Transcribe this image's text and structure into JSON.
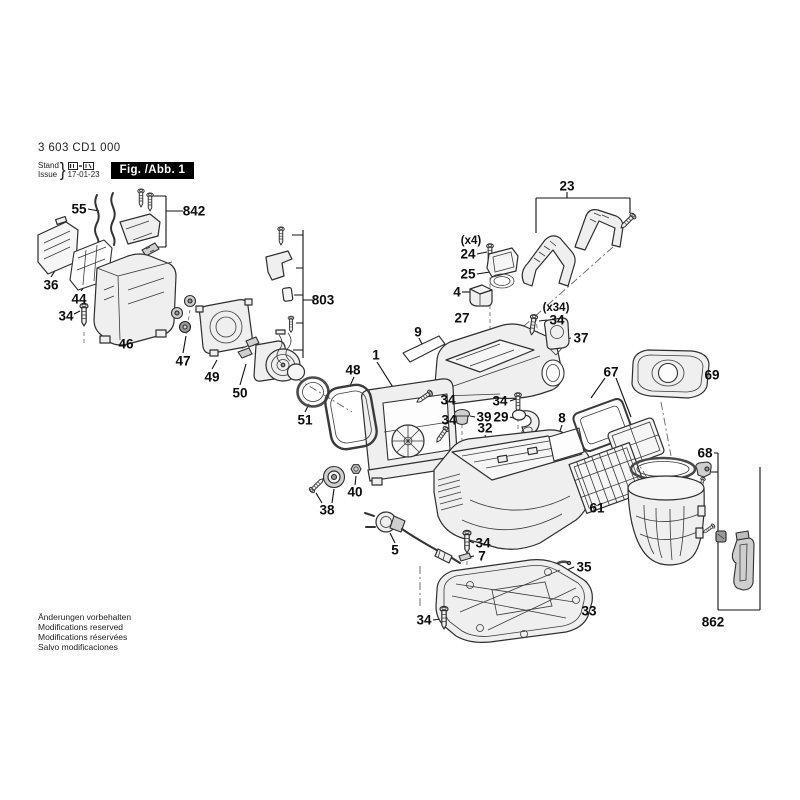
{
  "header": {
    "part_number": "3 603 CD1 000",
    "stand_label": "Stand",
    "issue_label": "Issue",
    "brace": "}",
    "date": "17-01-23",
    "figure_label": "Fig. /Abb. 1"
  },
  "footer": {
    "lines": [
      "Änderungen vorbehalten",
      "Modifications reserved",
      "Modifications réservées",
      "Salvo modificaciones"
    ]
  },
  "diagram": {
    "ink_color": "#111111",
    "badge_bg": "#000000",
    "badge_fg": "#ffffff",
    "labels": [
      {
        "text": "55",
        "x": 79,
        "y": 209
      },
      {
        "text": "842",
        "x": 194,
        "y": 211
      },
      {
        "text": "36",
        "x": 51,
        "y": 285
      },
      {
        "text": "44",
        "x": 79,
        "y": 299
      },
      {
        "text": "34",
        "x": 66,
        "y": 316
      },
      {
        "text": "46",
        "x": 126,
        "y": 344
      },
      {
        "text": "47",
        "x": 183,
        "y": 361
      },
      {
        "text": "49",
        "x": 212,
        "y": 377
      },
      {
        "text": "50",
        "x": 240,
        "y": 393
      },
      {
        "text": "51",
        "x": 305,
        "y": 420
      },
      {
        "text": "803",
        "x": 323,
        "y": 300
      },
      {
        "text": "23",
        "x": 567,
        "y": 186
      },
      {
        "text": "(x4)",
        "x": 471,
        "y": 241
      },
      {
        "text": "24",
        "x": 468,
        "y": 254
      },
      {
        "text": "25",
        "x": 468,
        "y": 274
      },
      {
        "text": "4",
        "x": 457,
        "y": 292
      },
      {
        "text": "27",
        "x": 462,
        "y": 318
      },
      {
        "text": "(x34)",
        "x": 556,
        "y": 308
      },
      {
        "text": "34",
        "x": 557,
        "y": 320
      },
      {
        "text": "37",
        "x": 581,
        "y": 338
      },
      {
        "text": "9",
        "x": 418,
        "y": 332
      },
      {
        "text": "1",
        "x": 376,
        "y": 355
      },
      {
        "text": "48",
        "x": 353,
        "y": 370
      },
      {
        "text": "34",
        "x": 448,
        "y": 400
      },
      {
        "text": "34",
        "x": 500,
        "y": 401
      },
      {
        "text": "34",
        "x": 449,
        "y": 420
      },
      {
        "text": "39",
        "x": 484,
        "y": 417
      },
      {
        "text": "29",
        "x": 501,
        "y": 417
      },
      {
        "text": "32",
        "x": 485,
        "y": 428
      },
      {
        "text": "8",
        "x": 562,
        "y": 418
      },
      {
        "text": "67",
        "x": 611,
        "y": 372
      },
      {
        "text": "69",
        "x": 712,
        "y": 375
      },
      {
        "text": "68",
        "x": 705,
        "y": 453
      },
      {
        "text": "61",
        "x": 597,
        "y": 508
      },
      {
        "text": "40",
        "x": 355,
        "y": 492
      },
      {
        "text": "38",
        "x": 327,
        "y": 510
      },
      {
        "text": "5",
        "x": 395,
        "y": 550
      },
      {
        "text": "34",
        "x": 483,
        "y": 543
      },
      {
        "text": "7",
        "x": 482,
        "y": 556
      },
      {
        "text": "35",
        "x": 584,
        "y": 567
      },
      {
        "text": "33",
        "x": 589,
        "y": 611
      },
      {
        "text": "34",
        "x": 424,
        "y": 620
      },
      {
        "text": "862",
        "x": 713,
        "y": 622
      }
    ]
  }
}
